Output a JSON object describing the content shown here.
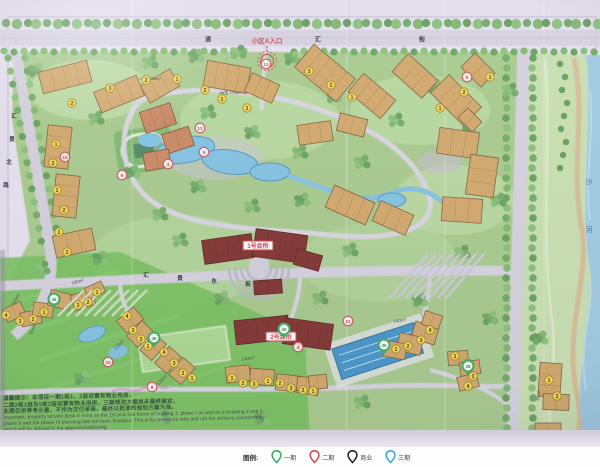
{
  "map": {
    "entrance": {
      "label": "小区A入口"
    },
    "clubs": [
      {
        "label": "1号会所",
        "x": 258,
        "y": 246
      },
      {
        "label": "2号会所",
        "x": 281,
        "y": 337
      }
    ],
    "roads": {
      "top": [
        "通",
        "汇",
        "街"
      ],
      "left": [
        "汇",
        "景",
        "北",
        "路"
      ],
      "middle": [
        "汇",
        "景",
        "东",
        "街"
      ],
      "river": [
        "沙",
        "河"
      ]
    },
    "unit_type_labels": [
      {
        "text": "C2型 258m²",
        "x": 150,
        "y": 80
      },
      {
        "text": "A6型 175m²",
        "x": 230,
        "y": 94
      }
    ],
    "area_labels": [
      {
        "text": "180m²",
        "x": 78,
        "y": 283,
        "r": -15
      },
      {
        "text": "140m²",
        "x": 17,
        "y": 300,
        "r": -58
      },
      {
        "text": "90m²",
        "x": 34,
        "y": 330,
        "r": -66
      },
      {
        "text": "120m²",
        "x": 120,
        "y": 346,
        "r": -46
      },
      {
        "text": "130m²",
        "x": 163,
        "y": 381,
        "r": -46
      },
      {
        "text": "140m²",
        "x": 248,
        "y": 360,
        "r": -8
      },
      {
        "text": "140m²",
        "x": 400,
        "y": 322,
        "r": -8
      },
      {
        "text": "90m²",
        "x": 540,
        "y": 396,
        "r": -78
      }
    ],
    "yellow_markers": [
      {
        "n": "2",
        "x": 72,
        "y": 103
      },
      {
        "n": "3",
        "x": 110,
        "y": 88
      },
      {
        "n": "2",
        "x": 146,
        "y": 80
      },
      {
        "n": "1",
        "x": 177,
        "y": 79
      },
      {
        "n": "2",
        "x": 205,
        "y": 90
      },
      {
        "n": "1",
        "x": 222,
        "y": 99
      },
      {
        "n": "1",
        "x": 247,
        "y": 108
      },
      {
        "n": "3",
        "x": 309,
        "y": 71
      },
      {
        "n": "2",
        "x": 331,
        "y": 85
      },
      {
        "n": "1",
        "x": 352,
        "y": 97
      },
      {
        "n": "1",
        "x": 440,
        "y": 108
      },
      {
        "n": "2",
        "x": 464,
        "y": 92
      },
      {
        "n": "1",
        "x": 490,
        "y": 77
      },
      {
        "n": "1",
        "x": 56,
        "y": 144
      },
      {
        "n": "2",
        "x": 53,
        "y": 163
      },
      {
        "n": "1",
        "x": 57,
        "y": 190
      },
      {
        "n": "2",
        "x": 64,
        "y": 210
      },
      {
        "n": "1",
        "x": 59,
        "y": 232
      },
      {
        "n": "2",
        "x": 67,
        "y": 252
      },
      {
        "n": "4",
        "x": 6,
        "y": 315
      },
      {
        "n": "3",
        "x": 20,
        "y": 321
      },
      {
        "n": "2",
        "x": 33,
        "y": 319
      },
      {
        "n": "1",
        "x": 44,
        "y": 312
      },
      {
        "n": "3",
        "x": 78,
        "y": 305
      },
      {
        "n": "2",
        "x": 88,
        "y": 302
      },
      {
        "n": "1",
        "x": 97,
        "y": 292
      },
      {
        "n": "4",
        "x": 127,
        "y": 316
      },
      {
        "n": "3",
        "x": 133,
        "y": 330
      },
      {
        "n": "2",
        "x": 141,
        "y": 339
      },
      {
        "n": "1",
        "x": 148,
        "y": 346
      },
      {
        "n": "4",
        "x": 164,
        "y": 352
      },
      {
        "n": "3",
        "x": 174,
        "y": 363
      },
      {
        "n": "2",
        "x": 183,
        "y": 373
      },
      {
        "n": "1",
        "x": 192,
        "y": 378
      },
      {
        "n": "1",
        "x": 232,
        "y": 378
      },
      {
        "n": "2",
        "x": 243,
        "y": 383
      },
      {
        "n": "3",
        "x": 254,
        "y": 384
      },
      {
        "n": "1",
        "x": 268,
        "y": 381
      },
      {
        "n": "2",
        "x": 280,
        "y": 383
      },
      {
        "n": "3",
        "x": 291,
        "y": 388
      },
      {
        "n": "2",
        "x": 303,
        "y": 390
      },
      {
        "n": "1",
        "x": 313,
        "y": 391
      },
      {
        "n": "4",
        "x": 430,
        "y": 330
      },
      {
        "n": "3",
        "x": 421,
        "y": 340
      },
      {
        "n": "2",
        "x": 408,
        "y": 346
      },
      {
        "n": "1",
        "x": 396,
        "y": 349
      },
      {
        "n": "1",
        "x": 455,
        "y": 356
      },
      {
        "n": "2",
        "x": 468,
        "y": 363
      },
      {
        "n": "3",
        "x": 473,
        "y": 376
      },
      {
        "n": "4",
        "x": 468,
        "y": 386
      },
      {
        "n": "1",
        "x": 549,
        "y": 380
      },
      {
        "n": "2",
        "x": 557,
        "y": 396
      }
    ],
    "red_markers": [
      {
        "n": "13",
        "x": 266,
        "y": 64
      },
      {
        "n": "12",
        "x": 200,
        "y": 128
      },
      {
        "n": "5",
        "x": 204,
        "y": 152
      },
      {
        "n": "4",
        "x": 168,
        "y": 164
      },
      {
        "n": "15",
        "x": 65,
        "y": 157
      },
      {
        "n": "6",
        "x": 122,
        "y": 175
      },
      {
        "n": "9",
        "x": 467,
        "y": 77
      },
      {
        "n": "10",
        "x": 108,
        "y": 362
      },
      {
        "n": "8",
        "x": 152,
        "y": 387
      },
      {
        "n": "21",
        "x": 348,
        "y": 321
      },
      {
        "n": "4",
        "x": 298,
        "y": 347
      }
    ],
    "green_pins": [
      {
        "n": "49",
        "x": 54,
        "y": 299
      },
      {
        "n": "46",
        "x": 154,
        "y": 338
      },
      {
        "n": "40",
        "x": 284,
        "y": 329
      },
      {
        "n": "39",
        "x": 384,
        "y": 345
      },
      {
        "n": "38",
        "x": 468,
        "y": 366
      }
    ],
    "colors": {
      "pin_green": "#2fae5a",
      "marker_yellow": "#f6d84b",
      "marker_red": "#cf4a50",
      "club_red": "#7c2b26",
      "water": "#86c6e2",
      "building_tan": "#d2a663"
    }
  },
  "disclaimer": {
    "cn_lines": [
      "温馨提示：本项目一期1栋1、2层设置有物业用房，",
      "二期2栋1层及5栋2层设置有物业用房，三期规划方案尚未最终确定，",
      "此图仅供参考示意，不作为交付承诺，最终以批准的规划方案为准。"
    ],
    "en_lines": [
      "Important: property service desk is sited on the 1st and 2nd floors of building 1, phase I as well as in building 2 and 5,",
      "phase II and the phase III planning has not been finalized. This is for reference only and not the delivery commitment,",
      "which will be defined in the approved planning."
    ]
  },
  "legend": {
    "title": "图例:",
    "items": [
      {
        "label": "一期",
        "color": "#2fae5a"
      },
      {
        "label": "二期",
        "color": "#d5465a"
      },
      {
        "label": "商业",
        "color": "#1e1e1e"
      },
      {
        "label": "三期",
        "color": "#35a6d8"
      }
    ]
  }
}
